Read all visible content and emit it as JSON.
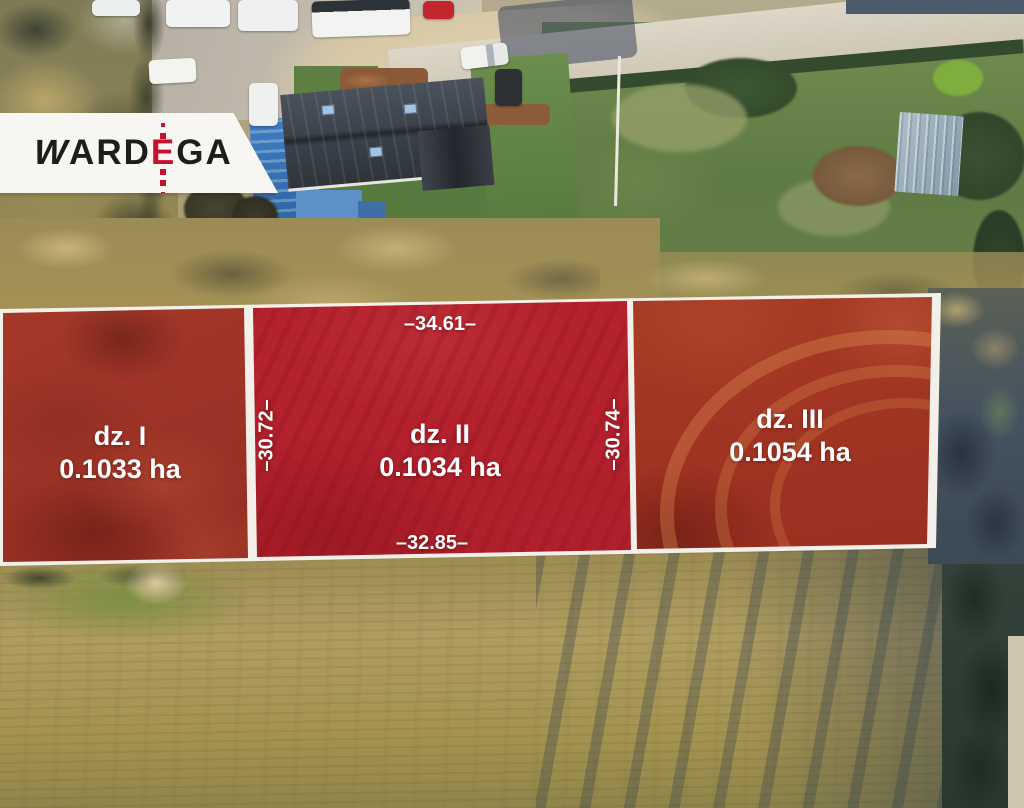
{
  "branding": {
    "logo": {
      "part1": "W",
      "part2": "ARD",
      "accent": "E",
      "part3": "GA"
    },
    "accent_color": "#c8102e",
    "text_color": "#1d1d1b"
  },
  "parcels": [
    {
      "name": "dz. I",
      "area": "0.1033 ha"
    },
    {
      "name": "dz. II",
      "area": "0.1034 ha"
    },
    {
      "name": "dz. III",
      "area": "0.1054 ha"
    }
  ],
  "measurements": {
    "top": "–34.61–",
    "bottom": "–32.85–",
    "left": "–30.72–",
    "right": "–30.74–"
  },
  "overlay_colors": {
    "parcel_fill": "#b7242f",
    "border": "#f3f0e9",
    "label": "#ffffff"
  }
}
